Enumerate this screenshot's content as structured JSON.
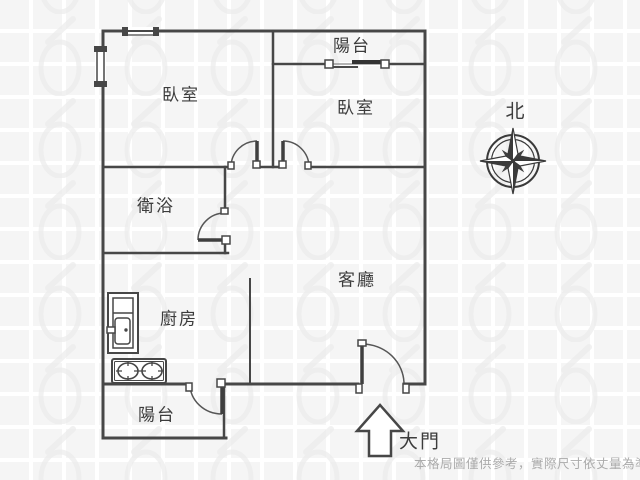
{
  "rooms": {
    "bedroom_left": {
      "label": "臥室"
    },
    "bedroom_right": {
      "label": "臥室"
    },
    "balcony_top": {
      "label": "陽台"
    },
    "balcony_bottom": {
      "label": "陽台"
    },
    "bathroom": {
      "label": "衛浴"
    },
    "kitchen": {
      "label": "廚房"
    },
    "living_room": {
      "label": "客廳"
    }
  },
  "compass": {
    "label": "北"
  },
  "entrance": {
    "label": "大門"
  },
  "disclaimer": "本格局圖僅供參考，實際尺寸依丈量為準",
  "colors": {
    "wall": "#474747",
    "text": "#3c3c3c",
    "disclaimer_text": "#ababab",
    "tile": "#f5f5f5",
    "watermark": "#e9e9e9"
  }
}
